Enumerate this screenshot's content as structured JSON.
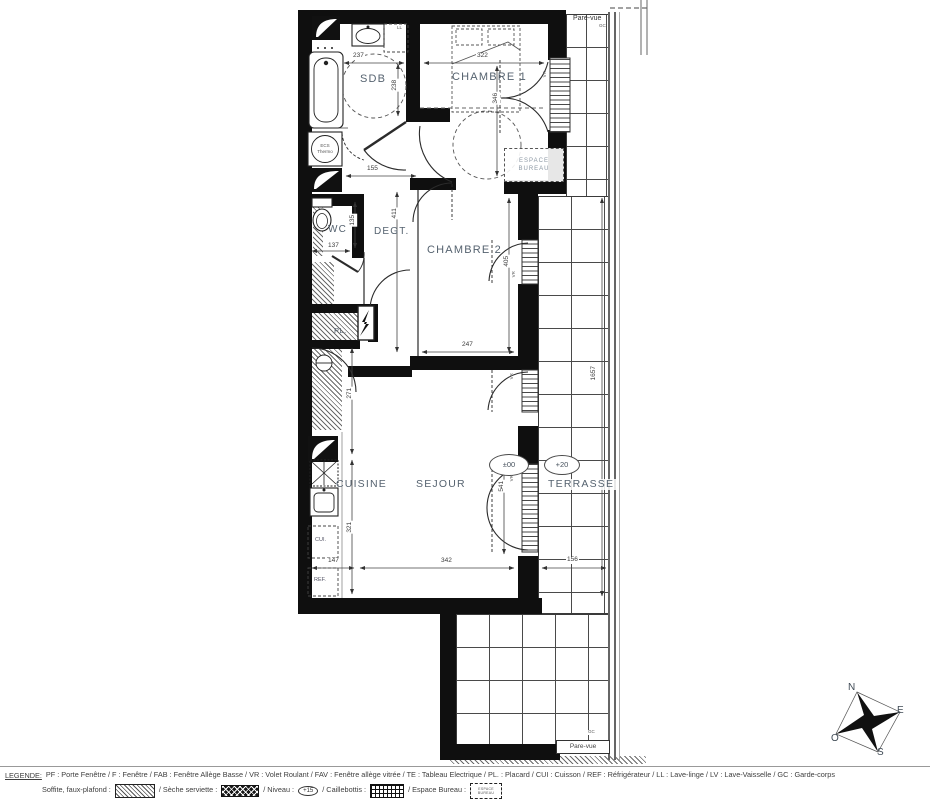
{
  "plan": {
    "rooms": {
      "sdb": "SDB",
      "chambre1": "CHAMBRE 1",
      "wc": "WC",
      "degt": "DEGT.",
      "chambre2": "CHAMBRE 2",
      "cuisine": "CUISINE",
      "sejour": "SEJOUR",
      "terrasse": "TERRASSE",
      "placard": "PL.",
      "espace_bureau_1": "ESPACE",
      "espace_bureau_2": "BUREAU"
    },
    "equipment": {
      "ll": "LL",
      "ecs_1": "ECS",
      "ecs_2": "Thermo",
      "cui": "CUI.",
      "ref": "REF."
    },
    "labels": {
      "vr": "VR",
      "gc": "GC",
      "pare_vue": "Pare-vue"
    },
    "levels": {
      "sejour": "±00",
      "terrasse": "+20"
    },
    "dims": {
      "d237": "237",
      "d238": "238",
      "d322": "322",
      "d346": "346",
      "d155": "155",
      "d137": "137",
      "d135": "135",
      "d411": "411",
      "d405": "405",
      "d247": "247",
      "d271": "271",
      "d321": "321",
      "d147": "147",
      "d342": "342",
      "d156": "156",
      "d541": "541",
      "d1657": "1657"
    },
    "compass": {
      "n": "N",
      "e": "E",
      "s": "S",
      "o": "O"
    }
  },
  "legend": {
    "title": "LEGENDE:",
    "line1": "PF : Porte Fenêtre / F : Fenêtre / FAB : Fenêtre Allège Basse / VR : Volet Roulant / FAV : Fenêtre allège vitrée / TE : Tableau Electrique / PL. : Placard / CUI : Cuisson / REF : Réfrigérateur / LL : Lave-linge / LV : Lave-Vaisselle / GC : Garde-corps",
    "soffite": "Soffite, faux-plafond :",
    "seche": "/ Sèche serviette :",
    "niveau": "/ Niveau :",
    "niveau_value": "+15",
    "caillebottis": "/ Caillebottis :",
    "espace_bureau": "/ Espace Bureau :",
    "espace_swatch": "ESPACE BUREAU"
  }
}
